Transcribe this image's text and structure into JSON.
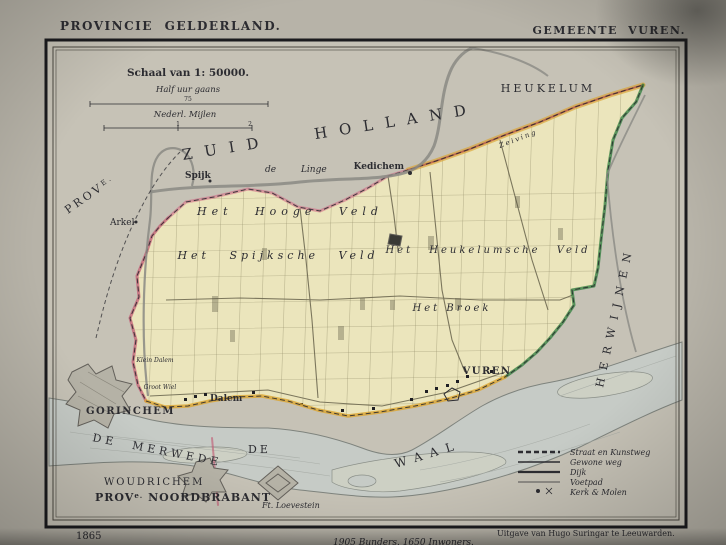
{
  "titles": {
    "province": "PROVINCIE GELDERLAND.",
    "municipality": "GEMEENTE VUREN."
  },
  "scale": {
    "heading": "Schaal van 1: 50000.",
    "bar1_label": "Half uur gaans",
    "bar1_mid": "75",
    "bar2_label": "Nederl. Mijlen",
    "bar2_mid": "1",
    "bar2_end": "2"
  },
  "regions": {
    "prov_prefix": "PROV",
    "prov_sup": "E.",
    "zuid_holland": "ZUID HOLLAND",
    "herwijnen": "HERWIJNEN",
    "nb_p1": "PROV",
    "nb_sup": "e.",
    "nb_p2": " NOORDBRABANT"
  },
  "places": {
    "heukelum": "HEUKELUM",
    "kedichem": "Kedichem",
    "spijk": "Spijk",
    "arkel": "Arkel",
    "gorinchem": "GORINCHEM",
    "dalem": "Dalem",
    "vuren": "VUREN",
    "woudrichem": "WOUDRICHEM",
    "loevestein": "Ft. Loevestein"
  },
  "waters": {
    "linge": "de  Linge",
    "merwede": "DE MERWEDE",
    "waal_de": "DE",
    "waal": "WAAL"
  },
  "fields": {
    "hooge_veld": "Het Hooge Veld",
    "spijksche_veld": "Het Spijksche Veld",
    "heukelumsche_veld": "Het Heukelumsche Veld",
    "broek": "Het Broek",
    "zeiving": "Zeiving",
    "groot_wiel": "Groot Wiel",
    "klein_dalem": "Klein Dalem"
  },
  "legend": {
    "items": [
      {
        "symbol": "bold-dashed-line",
        "label": "Straat en Kunstweg"
      },
      {
        "symbol": "solid-line",
        "label": "Gewone weg"
      },
      {
        "symbol": "thick-line",
        "label": "Dijk"
      },
      {
        "symbol": "thin-line",
        "label": "Voetpad"
      },
      {
        "symbol": "dot-and-cross",
        "label": "Kerk & Molen"
      }
    ]
  },
  "footer": {
    "year": "1865",
    "stats": "1905 Bunders.   1650 Inwoners.",
    "imprint": "Uitgave van Hugo Suringar te Leeuwarden."
  },
  "colors": {
    "paper": "#b7b3a8",
    "map_bg": "#c6c2b6",
    "municipality": "#ebe5bc",
    "water": "#c6cbc6",
    "island": "#cdd0c4",
    "edge_red": "#c2556f",
    "edge_green": "#2f7d3c",
    "edge_orange": "#dca52f",
    "ink": "#2c2c31"
  }
}
